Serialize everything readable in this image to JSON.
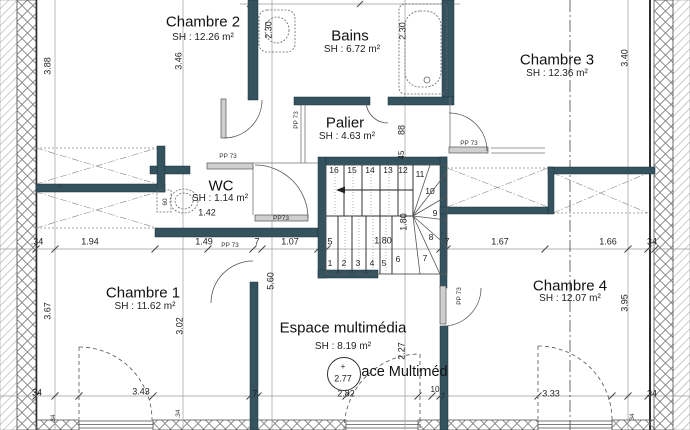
{
  "rooms": {
    "chambre2": {
      "name": "Chambre 2",
      "area": "SH : 12.26 m²"
    },
    "bains": {
      "name": "Bains",
      "area": "SH : 6.72 m²"
    },
    "chambre3": {
      "name": "Chambre 3",
      "area": "SH : 12.36 m²"
    },
    "palier": {
      "name": "Palier",
      "area": "SH : 4.63 m²"
    },
    "wc": {
      "name": "WC",
      "area": "SH : 1.14 m²"
    },
    "chambre1": {
      "name": "Chambre 1",
      "area": "SH : 11.62 m²"
    },
    "espace": {
      "name": "Espace multimédia",
      "area": "SH : 8.19 m²",
      "overlay_name": "Espace Multiméd"
    },
    "chambre4": {
      "name": "Chambre 4",
      "area": "SH : 12.07 m²"
    }
  },
  "level_marker": {
    "sign": "+",
    "value": "2.77"
  },
  "door_tag": "PP 73",
  "door_tag_compact": "PP73",
  "dims": {
    "mid_row": [
      ".34",
      "1.94",
      "1.49",
      "7",
      "1.07",
      "5",
      "1.80",
      "7",
      "1.67",
      "1.66",
      "34"
    ],
    "bottom_row": [
      "34",
      "3.43",
      "7",
      "2.82",
      "10",
      "7",
      "3.33",
      "34"
    ],
    "vertical": {
      "left_upper": "3.88",
      "left_lower": "3.67",
      "chambre2": "3.46",
      "chambre1": "3.02",
      "basin": "2.30",
      "bath": "2.30",
      "chambre3": "3.40",
      "chambre4": "3.95",
      "center": "5.60",
      "espace": "2.27",
      "palier_a": "88",
      "palier_b": "45",
      "wc_width": "60",
      "wall_thickness": "7"
    },
    "wc_inner": "1.42",
    "stair_width": "1.80",
    "small_a": ".34",
    "small_b": ".34",
    "small_c": "34"
  },
  "stairs": {
    "steps": [
      "1",
      "2",
      "3",
      "4",
      "5",
      "6",
      "7",
      "8",
      "9",
      "10",
      "11",
      "12",
      "13",
      "14",
      "15",
      "16"
    ]
  },
  "colors": {
    "wall": "#35535f",
    "line": "#555555",
    "dim_line": "#9a9a9a"
  }
}
